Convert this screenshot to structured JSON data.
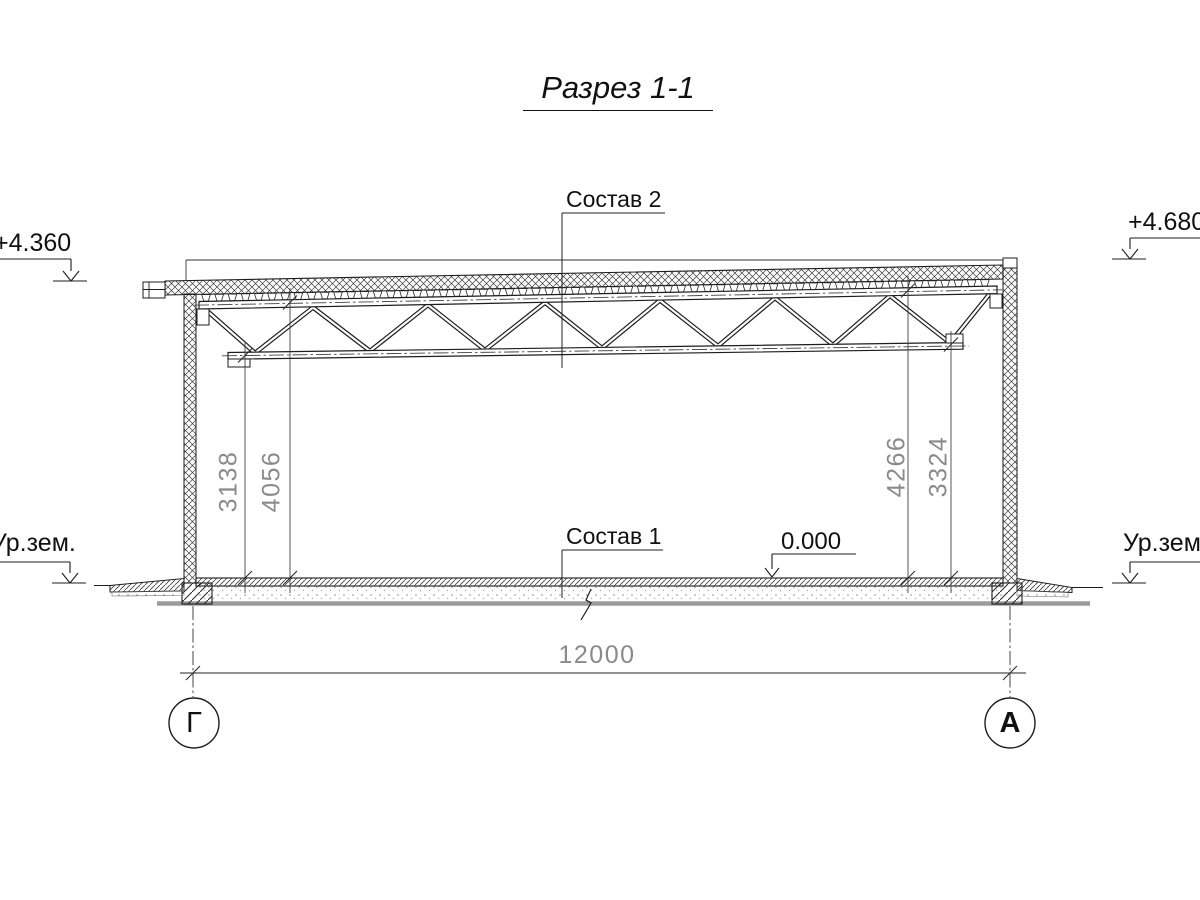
{
  "title": "Разрез 1-1",
  "callouts": {
    "roof_composition": "Состав 2",
    "floor_composition": "Состав 1"
  },
  "levels": {
    "roof_left": "+4.360",
    "roof_right": "+4.680",
    "floor_zero": "0.000",
    "ground_left": "Ур.зем.",
    "ground_right": "Ур.зем."
  },
  "dimensions": {
    "floor_to_truss_bottom_left": "3138",
    "floor_to_truss_top_left": "4056",
    "floor_to_truss_top_right": "4266",
    "floor_to_truss_bottom_right": "3324",
    "span": "12000"
  },
  "axes": {
    "left": "Г",
    "right": "А"
  },
  "colors": {
    "line": "#1d1d1d",
    "thin": "#3c3c3c",
    "dim_text": "#8a8a8a",
    "ground": "#9b9b9b",
    "bg": "#ffffff"
  }
}
